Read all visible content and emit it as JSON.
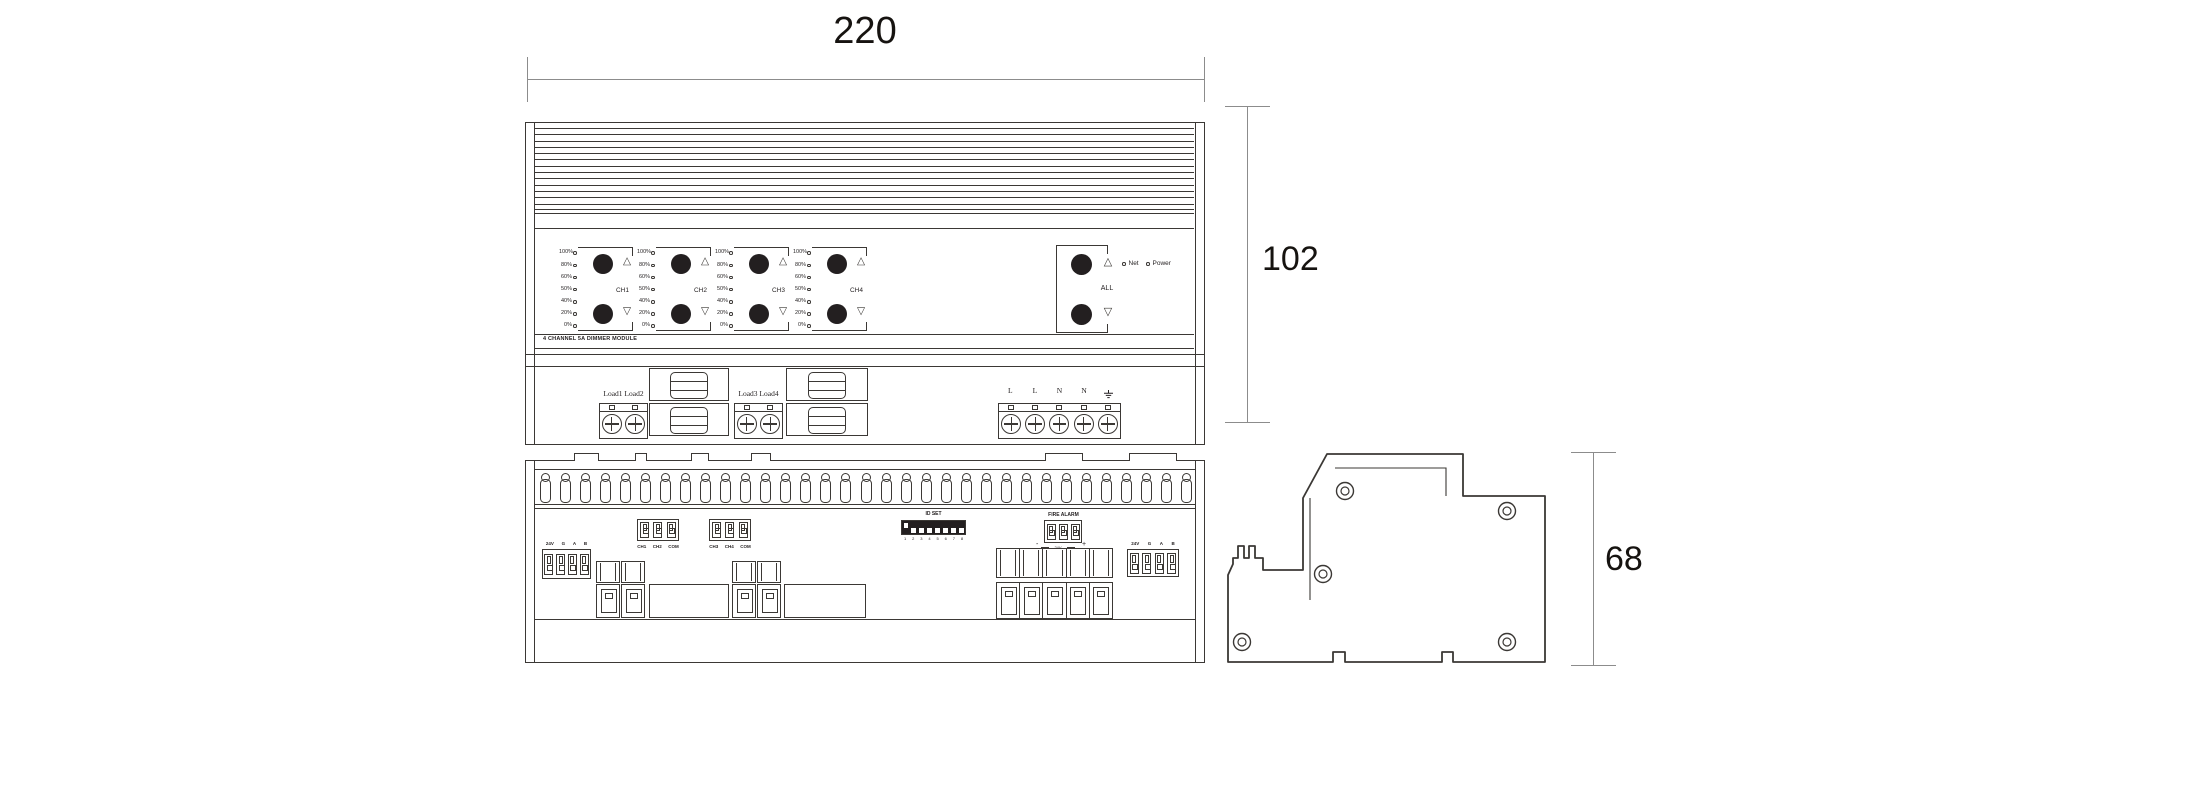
{
  "dimensions": {
    "width": "220",
    "height": "102",
    "depth": "68"
  },
  "front_view": {
    "module_title": "4 CHANNEL 5A DIMMER MODULE",
    "led_scale": [
      "100%",
      "80%",
      "60%",
      "50%",
      "40%",
      "20%",
      "0%"
    ],
    "channels": [
      "CH1",
      "CH2",
      "CH3",
      "CH4"
    ],
    "up_symbol": "△",
    "down_symbol": "▽",
    "all_group": {
      "label": "ALL",
      "net": "Net",
      "power": "Power"
    },
    "load_labels": [
      "Load1 Load2",
      "Load3 Load4"
    ],
    "power_terminals": [
      "L",
      "L",
      "N",
      "N"
    ],
    "earth_icon": "earth-ground"
  },
  "bottom_view": {
    "bus_connector_labels": [
      "24V",
      "G",
      "A",
      "B"
    ],
    "channel_connectors": [
      {
        "labels": [
          "CH1",
          "CH2",
          "COM"
        ]
      },
      {
        "labels": [
          "CH3",
          "CH4",
          "COM"
        ]
      }
    ],
    "id_set": {
      "label": "ID SET",
      "positions": [
        "1",
        "2",
        "3",
        "4",
        "5",
        "6",
        "7",
        "8"
      ]
    },
    "fire_alarm": {
      "label": "FIRE ALARM",
      "minus": "-",
      "plus": "+",
      "voltage": "24V"
    }
  }
}
